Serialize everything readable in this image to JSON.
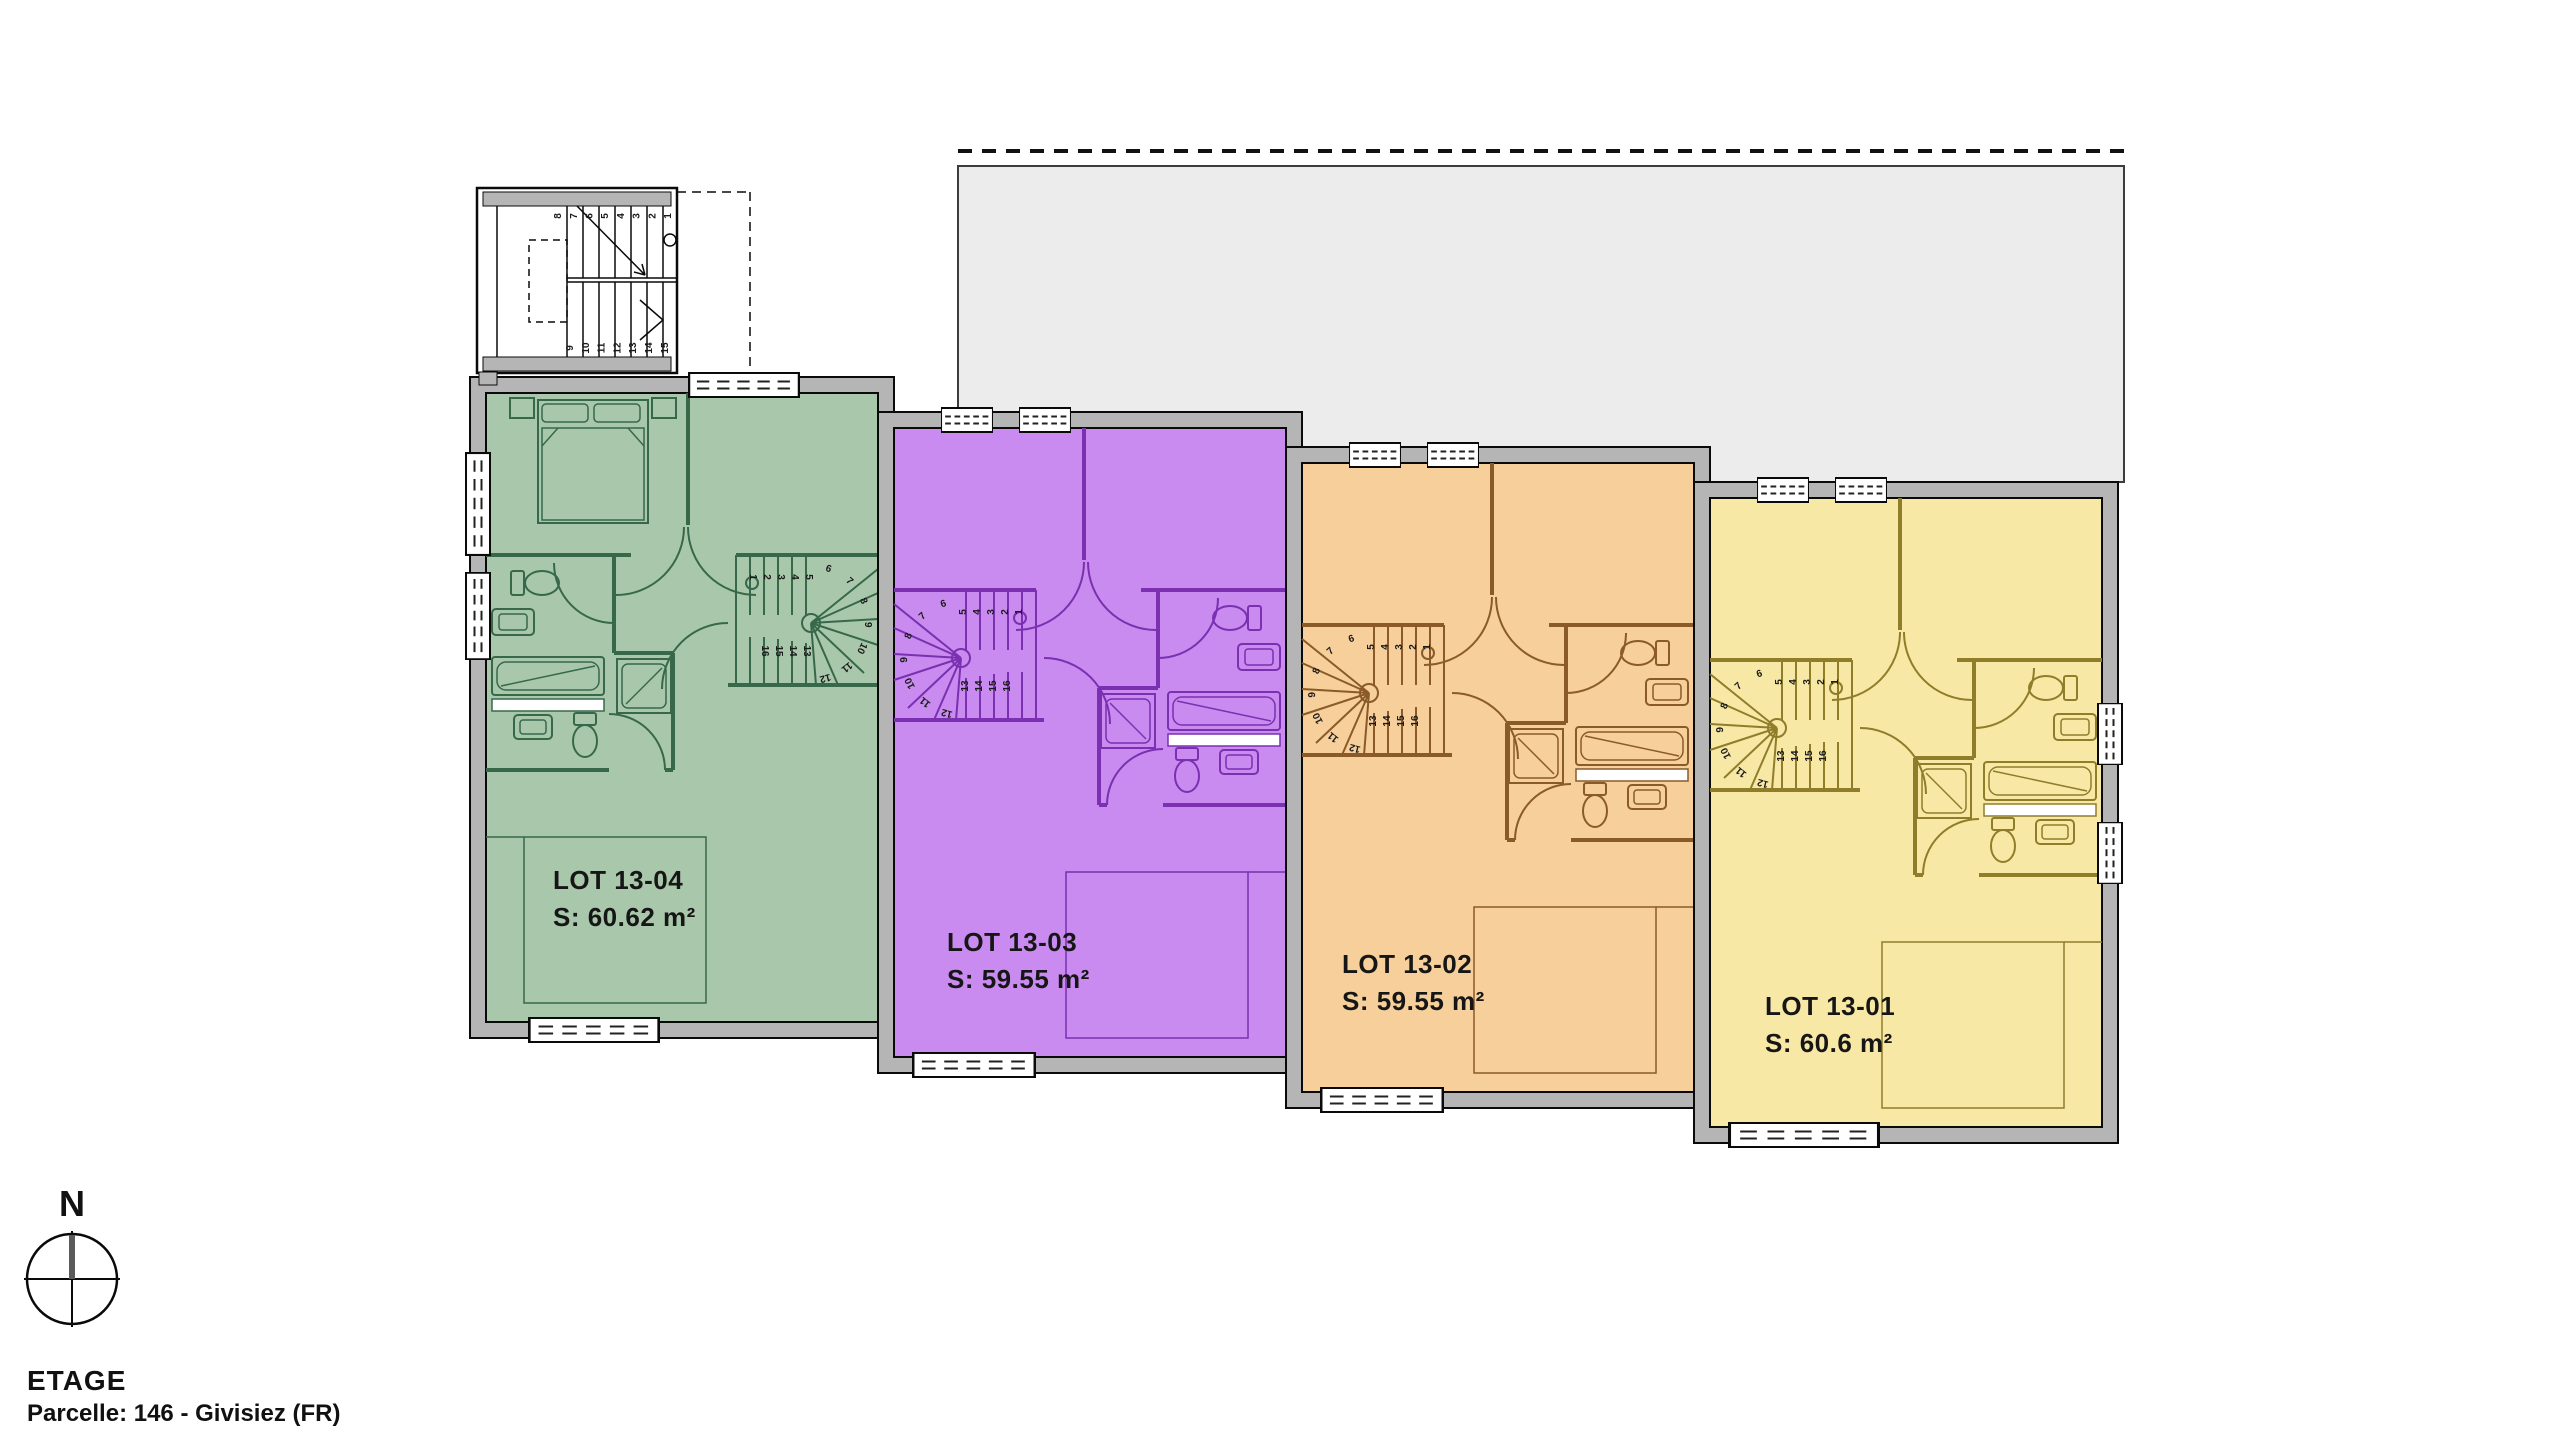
{
  "plan": {
    "title": "ETAGE",
    "subtitle": "Parcelle: 146 - Givisiez (FR)"
  },
  "compass": {
    "north_label": "N"
  },
  "units": [
    {
      "name": "LOT 13-04",
      "area": "S: 60.62 m²",
      "fill": "#a9c7ab",
      "stroke": "#37684a"
    },
    {
      "name": "LOT 13-03",
      "area": "S: 59.55 m²",
      "fill": "#c98bef",
      "stroke": "#7a30b0"
    },
    {
      "name": "LOT 13-02",
      "area": "S: 59.55 m²",
      "fill": "#f6cf9b",
      "stroke": "#8a5a28"
    },
    {
      "name": "LOT 13-01",
      "area": "S: 60.6 m²",
      "fill": "#f7e8a6",
      "stroke": "#8f7d2a"
    }
  ],
  "stairs": {
    "unit_treads": [
      "1",
      "2",
      "3",
      "4",
      "5",
      "6",
      "7",
      "8",
      "9",
      "10",
      "11",
      "12",
      "13",
      "14",
      "15",
      "16"
    ],
    "external_upper": [
      "1",
      "2",
      "3",
      "4",
      "5",
      "6",
      "7",
      "8"
    ],
    "external_lower": [
      "9",
      "10",
      "11",
      "12",
      "13",
      "14",
      "15"
    ]
  },
  "palette": {
    "exterior_wall": "#b5b5b5",
    "terrace": "#ececec",
    "outline": "#0a0a0a",
    "background": "#ffffff"
  }
}
